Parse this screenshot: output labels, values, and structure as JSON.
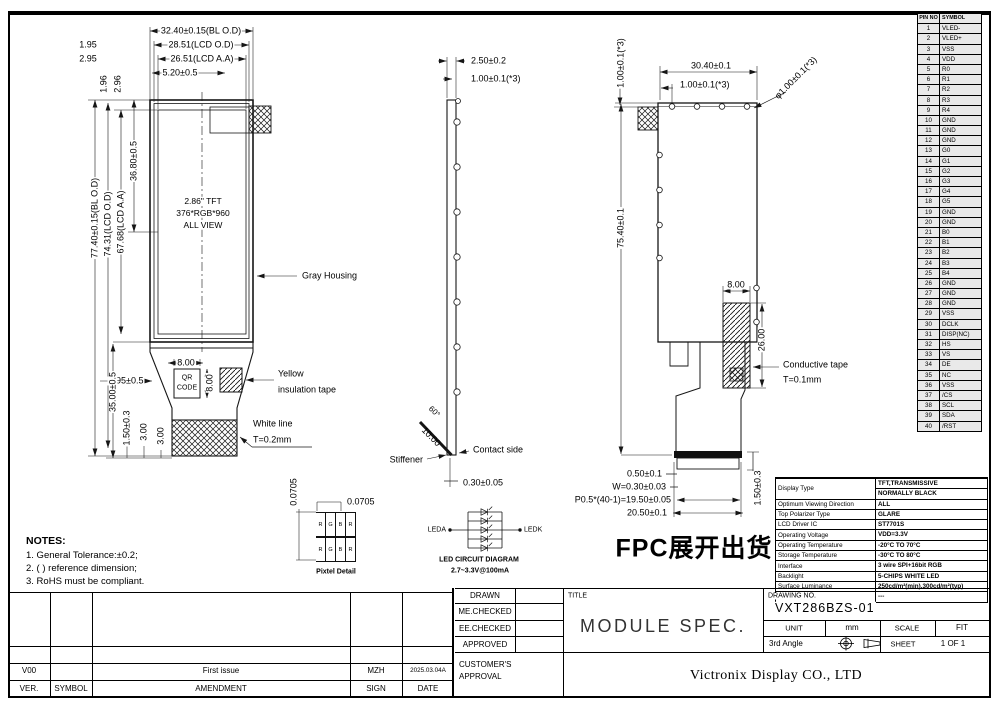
{
  "notes": {
    "title": "NOTES:",
    "items": [
      "1. General Tolerance:±0.2;",
      "2. ( ) reference dimension;",
      "3. RoHS must be compliant."
    ]
  },
  "front_view": {
    "dim_bl_od": "32.40±0.15(BL O.D)",
    "dim_195": "1.95",
    "dim_lcd_od": "28.51(LCD O.D)",
    "dim_295": "2.95",
    "dim_lcd_aa": "26.51(LCD A.A)",
    "dim_520": "5.20±0.5",
    "dim_196": "1.96",
    "dim_296": "2.96",
    "dim_height_bl": "77.40±0.15(BL O.D)",
    "dim_height_lcd": "74.31(LCD O.D)",
    "dim_height_aa": "67.68(LCD A.A)",
    "dim_3680": "36.80±0.5",
    "panel_line1": "2.86\" TFT",
    "panel_line2": "376*RGB*960",
    "panel_line3": "ALL VIEW",
    "label_gray_housing": "Gray Housing",
    "dim_qr_w": "8.00",
    "qr_line1": "QR",
    "qr_line2": "CODE",
    "dim_qr_h": "8.00",
    "dim_395": "3.95±0.5",
    "label_yellow_tape_1": "Yellow",
    "label_yellow_tape_2": "insulation tape",
    "dim_3500": "35.00±0.5",
    "dim_150": "1.50±0.3",
    "dim_300a": "3.00",
    "dim_300b": "3.00",
    "label_white_line_1": "White line",
    "label_white_line_2": "T=0.2mm"
  },
  "side_view": {
    "dim_250": "2.50±0.2",
    "dim_100": "1.00±0.1(*3)",
    "dim_60": "60°",
    "dim_1000": "10.00",
    "label_stiffener": "Stiffener",
    "label_contact": "Contact side",
    "dim_030": "0.30±0.05"
  },
  "fpc_view": {
    "dim_100_left": "1.00±0.1(*3)",
    "dim_3040": "30.40±0.1",
    "dim_100_top": "1.00±0.1(*3)",
    "dim_dia": "φ1.00±0.1(*3)",
    "dim_7540": "75.40±0.1",
    "dim_800": "8.00",
    "dim_2600": "26.00",
    "label_tape_1": "Conductive tape",
    "label_tape_2": "T=0.1mm",
    "dim_050": "0.50±0.1",
    "dim_w": "W=0.30±0.03",
    "dim_pitch": "P0.5*(40-1)=19.50±0.05",
    "dim_2050": "20.50±0.1",
    "dim_150": "1.50±0.3",
    "note": "FPC展开出货"
  },
  "pixel_detail": {
    "dim_v": "0.0705",
    "dim_h": "0.0705",
    "cells": [
      "R",
      "G",
      "B",
      "R"
    ],
    "label": "Pixtel Detail"
  },
  "led_diagram": {
    "anode": "LEDA",
    "cathode": "LEDK",
    "title": "LED CIRCUIT DIAGRAM",
    "subtitle": "2.7~3.3V@100mA"
  },
  "pin_table": {
    "headers": [
      "PIN NO",
      "SYMBOL"
    ],
    "rows": [
      [
        "1",
        "VLED-"
      ],
      [
        "2",
        "VLED+"
      ],
      [
        "3",
        "VSS"
      ],
      [
        "4",
        "VDD"
      ],
      [
        "5",
        "R0"
      ],
      [
        "6",
        "R1"
      ],
      [
        "7",
        "R2"
      ],
      [
        "8",
        "R3"
      ],
      [
        "9",
        "R4"
      ],
      [
        "10",
        "GND"
      ],
      [
        "11",
        "GND"
      ],
      [
        "12",
        "GND"
      ],
      [
        "13",
        "G0"
      ],
      [
        "14",
        "G1"
      ],
      [
        "15",
        "G2"
      ],
      [
        "16",
        "G3"
      ],
      [
        "17",
        "G4"
      ],
      [
        "18",
        "G5"
      ],
      [
        "19",
        "GND"
      ],
      [
        "20",
        "GND"
      ],
      [
        "21",
        "B0"
      ],
      [
        "22",
        "B1"
      ],
      [
        "23",
        "B2"
      ],
      [
        "24",
        "B3"
      ],
      [
        "25",
        "B4"
      ],
      [
        "26",
        "GND"
      ],
      [
        "27",
        "GND"
      ],
      [
        "28",
        "GND"
      ],
      [
        "29",
        "VSS"
      ],
      [
        "30",
        "DCLK"
      ],
      [
        "31",
        "DISP(NC)"
      ],
      [
        "32",
        "HS"
      ],
      [
        "33",
        "VS"
      ],
      [
        "34",
        "DE"
      ],
      [
        "35",
        "NC"
      ],
      [
        "36",
        "VSS"
      ],
      [
        "37",
        "/CS"
      ],
      [
        "38",
        "SCL"
      ],
      [
        "39",
        "SDA"
      ],
      [
        "40",
        "/RST"
      ]
    ]
  },
  "spec_table": {
    "rows": [
      {
        "label": "Display Type",
        "v1": "TFT,TRANSMISSIVE",
        "v2": "NORMALLY BLACK"
      },
      {
        "label": "Optimum Viewing Direction",
        "v1": "ALL",
        "v2": ""
      },
      {
        "label": "Top Polarizer Type",
        "v1": "GLARE",
        "v2": ""
      },
      {
        "label": "LCD Driver IC",
        "v1": "ST7701S",
        "v2": ""
      },
      {
        "label": "Operating Voltage",
        "v1": "VDD=3.3V",
        "v2": ""
      },
      {
        "label": "Operating Temperature",
        "v1": "-20°C TO 70°C",
        "v2": ""
      },
      {
        "label": "Storage Temperature",
        "v1": "-30°C TO 80°C",
        "v2": ""
      },
      {
        "label": "Interface",
        "v1": "3 wire SPI+16bit RGB",
        "v2": ""
      },
      {
        "label": "Backlight",
        "v1": "5-CHIPS WHITE LED",
        "v2": ""
      },
      {
        "label": "Surface Luminance",
        "v1": "250cd/m²(min),300cd/m²(typ)",
        "v2": ""
      },
      {
        "label": "White X/Y",
        "v1": "---",
        "v2": ""
      }
    ]
  },
  "title_block": {
    "sign_labels": [
      "DRAWN",
      "ME.CHECKED",
      "EE.CHECKED",
      "APPROVED"
    ],
    "customer_approval": "CUSTOMER'S APPROVAL",
    "title_label": "TITLE",
    "title": "MODULE SPEC.",
    "drawing_no_label": "DRAWING NO.",
    "drawing_no": "VXT286BZS-01",
    "unit_label": "UNIT",
    "unit_value": "mm",
    "scale_label": "SCALE",
    "scale_value": "FIT",
    "angle_label": "3rd Angle",
    "sheet_label": "SHEET",
    "sheet_value": "1 OF 1",
    "company": "Victronix Display CO., LTD"
  },
  "revision": {
    "ver": "V00",
    "symbol": "",
    "amendment": "First issue",
    "sign": "MZH",
    "date": "2025.03.04A",
    "headers": [
      "VER.",
      "SYMBOL",
      "AMENDMENT",
      "SIGN",
      "DATE"
    ]
  }
}
